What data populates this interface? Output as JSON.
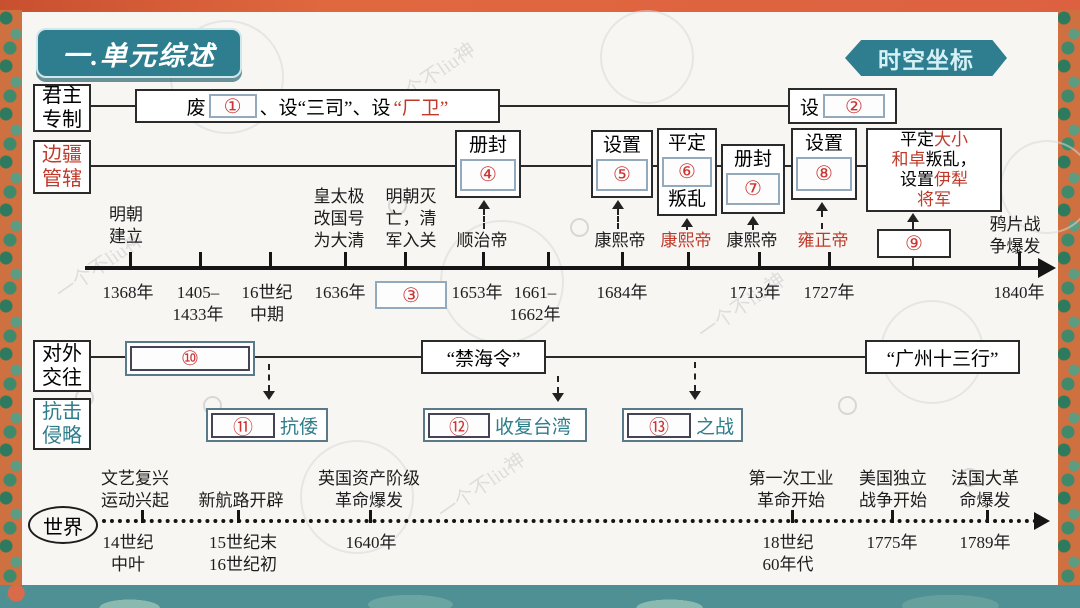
{
  "banner": {
    "title": "一.单元综述",
    "corner": "时空坐标"
  },
  "watermark": "一个不liu神",
  "rows": {
    "monarchy": {
      "label": "君主\n专制",
      "seg_fei": "废",
      "num1": "①",
      "seg_mid": "、设“三司”、设",
      "seg_red": "“厂卫”",
      "seg_she": "设",
      "num2": "②"
    },
    "frontier": {
      "label": "边疆\n管辖",
      "boxes": [
        {
          "top": "册封",
          "num": "④"
        },
        {
          "top": "设置",
          "num": "⑤"
        },
        {
          "top": "平定",
          "num": "⑥",
          "bottom": "叛乱"
        },
        {
          "top": "册封",
          "num": "⑦"
        },
        {
          "top": "设置",
          "num": "⑧"
        }
      ],
      "big_box": {
        "l1_black": "平定",
        "l1_red": "大小",
        "l2_red": "和卓",
        "l2_black": "叛乱，",
        "l3_black": "设置",
        "l3_red": "伊犁",
        "l4_red": "将军"
      },
      "num9": "⑨"
    },
    "foreign": {
      "label": "对外\n交往",
      "num10": "⑩",
      "ban": "“禁海令”",
      "canton": "“广州十三行”"
    },
    "resist": {
      "label": "抗击\n侵略",
      "items": [
        {
          "num": "⑪",
          "label": "抗倭"
        },
        {
          "num": "⑫",
          "label": "收复台湾"
        },
        {
          "num": "⑬",
          "label": "之战"
        }
      ]
    },
    "world": {
      "label": "世界"
    }
  },
  "timeline": {
    "events_above": [
      {
        "text": "明朝\n建立"
      },
      {
        "text": "皇太极\n改国号\n为大清"
      },
      {
        "text": "明朝灭\n亡，清\n军入关"
      },
      {
        "text": "鸦片战\n争爆发"
      }
    ],
    "emperors": [
      {
        "name": "顺治帝"
      },
      {
        "name": "康熙帝"
      },
      {
        "name": "康熙帝"
      },
      {
        "name": "康熙帝"
      },
      {
        "name": "雍正帝"
      }
    ],
    "blank3": "③",
    "years": [
      "1368年",
      "1405–\n1433年",
      "16世纪\n中期",
      "1636年",
      "1653年",
      "1661–\n1662年",
      "1684年",
      "1713年",
      "1727年",
      "1840年"
    ]
  },
  "world_timeline": {
    "events": [
      {
        "name": "文艺复兴\n运动兴起",
        "year": "14世纪\n中叶"
      },
      {
        "name": "新航路开辟",
        "year": "15世纪末\n16世纪初"
      },
      {
        "name": "英国资产阶级\n革命爆发",
        "year": "1640年"
      },
      {
        "name": "第一次工业\n革命开始",
        "year": "18世纪\n60年代"
      },
      {
        "name": "美国独立\n战争开始",
        "year": "1775年"
      },
      {
        "name": "法国大革\n命爆发",
        "year": "1789年"
      }
    ]
  },
  "colors": {
    "teal": "#2e7e8f",
    "red": "#bf3a2b",
    "number_red": "#cc3333",
    "resist_text": "#2e7d8a",
    "frame_orange": "#dd6140"
  }
}
